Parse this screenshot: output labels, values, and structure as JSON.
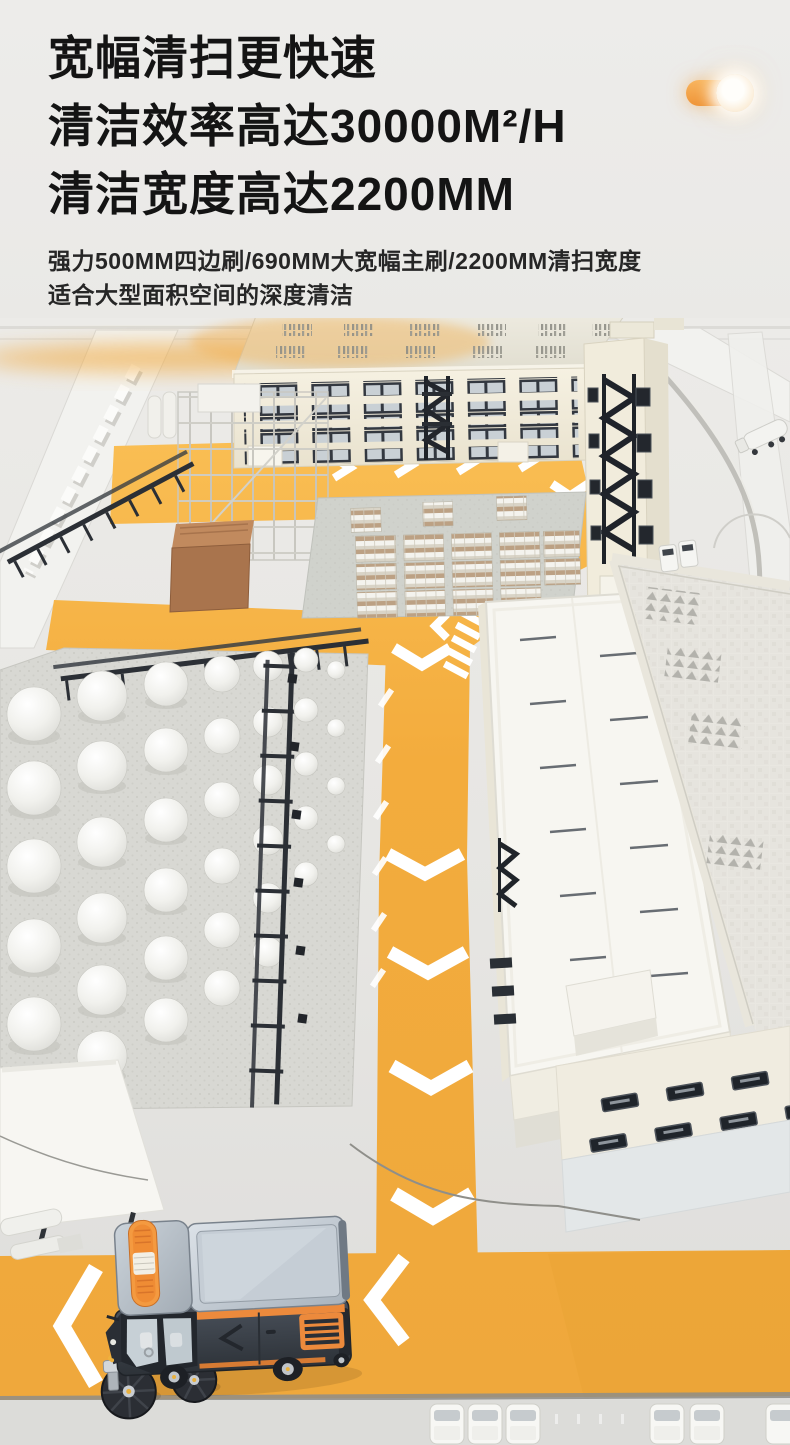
{
  "header": {
    "headline_lines": [
      "宽幅清扫更快速",
      "清洁效率高达30000M²/H",
      "清洁宽度高达2200MM"
    ],
    "subtitle_lines": [
      "强力500MM四边刷/690MM大宽幅主刷/2200MM清扫宽度",
      "适合大型面积空间的深度清洁"
    ],
    "toggle": {
      "state": "on"
    }
  },
  "palette": {
    "page_bg": "#ECEBE8",
    "headline_color": "#141414",
    "subtitle_color": "#262626",
    "road_yellow": "#F3AC3D",
    "arrow_white": "#FFFFFF",
    "toggle_orange": "#F2A04A"
  },
  "scene": {
    "type": "isometric-factory-campus-illustration",
    "elements": [
      "factory-building",
      "stair-tower",
      "scaffold-tower",
      "storage-tank-farm",
      "pallet-yard",
      "brown-storage-box",
      "pitched-roof-warehouse",
      "flat-roof-warehouse",
      "office-block",
      "road-network",
      "crosswalk-stripes",
      "sweeper-vehicle",
      "tanker-truck",
      "parked-vans",
      "loading-canopy"
    ],
    "sweeper": {
      "body": "#3A4049",
      "accent": "#EC8A3C",
      "beacon": "#F49A40",
      "cargo_roof": "#C7D0D9",
      "brushes": "#2B2E34"
    }
  }
}
